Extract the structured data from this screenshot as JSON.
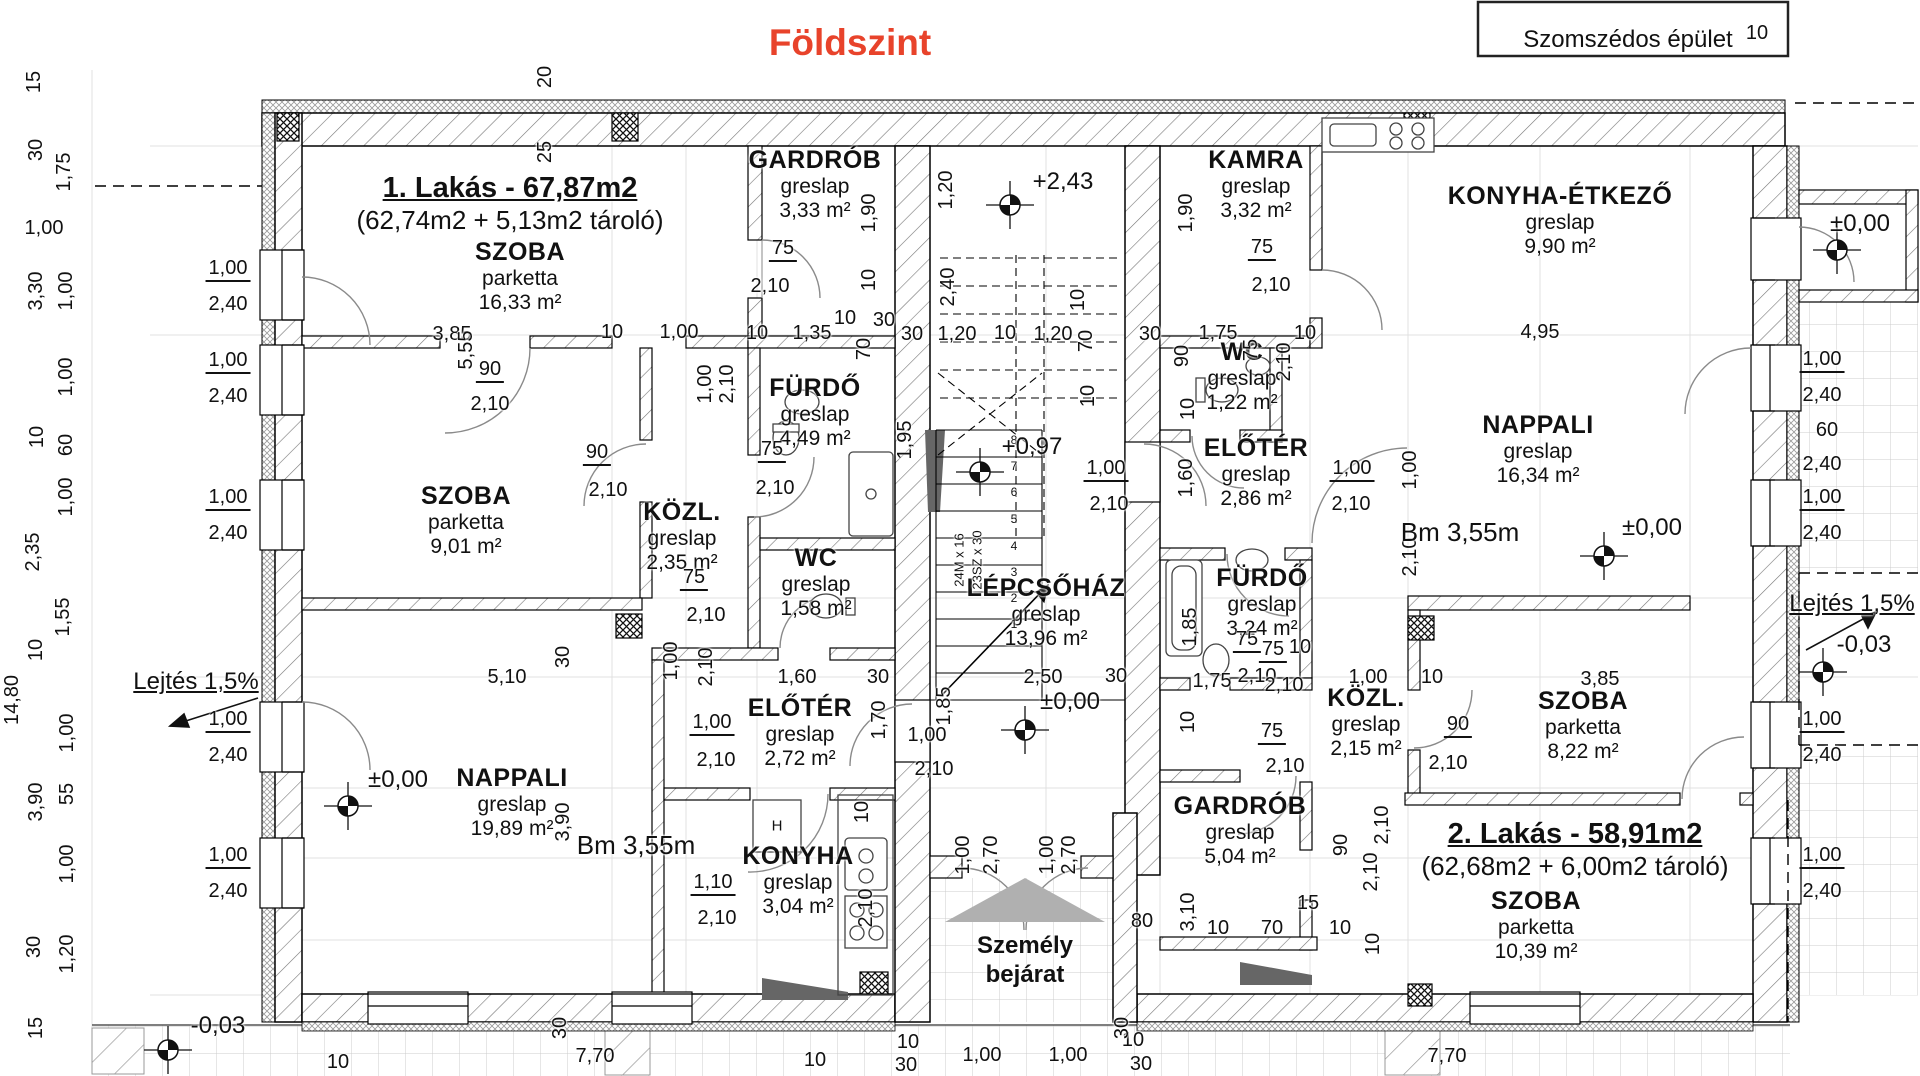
{
  "title": {
    "text": "Földszint",
    "color": "#e8432b"
  },
  "site": {
    "neighbor_label": "Szomszédos épület",
    "entrance_line1": "Személy",
    "entrance_line2": "bejárat",
    "slope_left": "Lejtés 1,5%",
    "slope_right": "Lejtés 1,5%"
  },
  "apartments": [
    {
      "name": "1. Lakás - 67,87m2",
      "detail": "(62,74m2 + 5,13m2 tároló)"
    },
    {
      "name": "2. Lakás - 58,91m2",
      "detail": "(62,68m2 + 6,00m2 tároló)"
    }
  ],
  "stairs": {
    "note1": "24M x 16",
    "note2": "23SZ x 30"
  },
  "kitchen": {
    "cabinet_label": "H"
  },
  "rooms": [
    {
      "name": "SZOBA",
      "floor": "parketta",
      "area": "16,33 m²",
      "cx": 520,
      "cy": 252
    },
    {
      "name": "GARDRÓB",
      "floor": "greslap",
      "area": "3,33 m²",
      "cx": 815,
      "cy": 160
    },
    {
      "name": "FÜRDŐ",
      "floor": "greslap",
      "area": "4,49 m²",
      "cx": 815,
      "cy": 388
    },
    {
      "name": "KÖZL.",
      "floor": "greslap",
      "area": "2,35 m²",
      "cx": 682,
      "cy": 512
    },
    {
      "name": "WC",
      "floor": "greslap",
      "area": "1,58 m²",
      "cx": 816,
      "cy": 558
    },
    {
      "name": "SZOBA",
      "floor": "parketta",
      "area": "9,01 m²",
      "cx": 466,
      "cy": 496
    },
    {
      "name": "LÉPCSŐHÁZ",
      "floor": "greslap",
      "area": "13,96 m²",
      "cx": 1046,
      "cy": 588
    },
    {
      "name": "ELŐTÉR",
      "floor": "greslap",
      "area": "2,72 m²",
      "cx": 800,
      "cy": 708
    },
    {
      "name": "NAPPALI",
      "floor": "greslap",
      "area": "19,89 m²",
      "cx": 512,
      "cy": 778
    },
    {
      "name": "KONYHA",
      "floor": "greslap",
      "area": "3,04 m²",
      "cx": 798,
      "cy": 856
    },
    {
      "name": "KAMRA",
      "floor": "greslap",
      "area": "3,32 m²",
      "cx": 1256,
      "cy": 160
    },
    {
      "name": "KONYHA-ÉTKEZŐ",
      "floor": "greslap",
      "area": "9,90 m²",
      "cx": 1560,
      "cy": 196
    },
    {
      "name": "WC",
      "floor": "greslap",
      "area": "1,22 m²",
      "cx": 1242,
      "cy": 352
    },
    {
      "name": "ELŐTÉR",
      "floor": "greslap",
      "area": "2,86 m²",
      "cx": 1256,
      "cy": 448
    },
    {
      "name": "NAPPALI",
      "floor": "greslap",
      "area": "16,34 m²",
      "cx": 1538,
      "cy": 425
    },
    {
      "name": "FÜRDŐ",
      "floor": "greslap",
      "area": "3,24 m²",
      "cx": 1262,
      "cy": 578
    },
    {
      "name": "KÖZL.",
      "floor": "greslap",
      "area": "2,15 m²",
      "cx": 1366,
      "cy": 698
    },
    {
      "name": "SZOBA",
      "floor": "parketta",
      "area": "8,22 m²",
      "cx": 1583,
      "cy": 701
    },
    {
      "name": "GARDRÓB",
      "floor": "greslap",
      "area": "5,04 m²",
      "cx": 1240,
      "cy": 806
    },
    {
      "name": "SZOBA",
      "floor": "parketta",
      "area": "10,39 m²",
      "cx": 1536,
      "cy": 901
    }
  ],
  "levels": [
    {
      "t": "+2,43",
      "x": 1063,
      "y": 182,
      "mx": 1010,
      "my": 205
    },
    {
      "t": "+0,97",
      "x": 1032,
      "y": 447,
      "mx": 980,
      "my": 472
    },
    {
      "t": "±0,00",
      "x": 1070,
      "y": 702,
      "mx": 1025,
      "my": 730
    },
    {
      "t": "±0,00",
      "x": 398,
      "y": 780,
      "mx": 348,
      "my": 806
    },
    {
      "t": "±0,00",
      "x": 1652,
      "y": 528,
      "mx": 1604,
      "my": 556
    },
    {
      "t": "±0,00",
      "x": 1860,
      "y": 224,
      "mx": 1837,
      "my": 250
    },
    {
      "t": "-0,03",
      "x": 1864,
      "y": 645,
      "mx": 1823,
      "my": 672
    },
    {
      "t": "-0,03",
      "x": 218,
      "y": 1026,
      "mx": 168,
      "my": 1050
    }
  ],
  "labels": [
    {
      "t": "20",
      "x": 545,
      "y": 77,
      "r": 1
    },
    {
      "t": "25",
      "x": 545,
      "y": 152,
      "r": 1
    },
    {
      "t": "15",
      "x": 34,
      "y": 82,
      "r": 1
    },
    {
      "t": "30",
      "x": 36,
      "y": 150,
      "r": 1
    },
    {
      "t": "1,75",
      "x": 64,
      "y": 172,
      "r": 1
    },
    {
      "t": "1,00",
      "x": 44,
      "y": 228
    },
    {
      "t": "3,30",
      "x": 36,
      "y": 291,
      "r": 1
    },
    {
      "t": "1,00",
      "x": 66,
      "y": 291,
      "r": 1
    },
    {
      "t": "1,00",
      "x": 66,
      "y": 377,
      "r": 1
    },
    {
      "t": "10",
      "x": 37,
      "y": 437,
      "r": 1
    },
    {
      "t": "60",
      "x": 66,
      "y": 445,
      "r": 1
    },
    {
      "t": "1,00",
      "x": 66,
      "y": 497,
      "r": 1
    },
    {
      "t": "2,35",
      "x": 33,
      "y": 552,
      "r": 1
    },
    {
      "t": "1,55",
      "x": 63,
      "y": 617,
      "r": 1
    },
    {
      "t": "10",
      "x": 36,
      "y": 650,
      "r": 1
    },
    {
      "t": "14,80",
      "x": 12,
      "y": 700,
      "r": 1
    },
    {
      "t": "1,00",
      "x": 67,
      "y": 733,
      "r": 1
    },
    {
      "t": "55",
      "x": 67,
      "y": 794,
      "r": 1
    },
    {
      "t": "3,90",
      "x": 36,
      "y": 802,
      "r": 1
    },
    {
      "t": "1,00",
      "x": 67,
      "y": 864,
      "r": 1
    },
    {
      "t": "30",
      "x": 34,
      "y": 947,
      "r": 1
    },
    {
      "t": "1,20",
      "x": 67,
      "y": 954,
      "r": 1
    },
    {
      "t": "15",
      "x": 36,
      "y": 1028,
      "r": 1
    },
    {
      "t": "1,00",
      "x": 228,
      "y": 270,
      "u": 1
    },
    {
      "t": "2,40",
      "x": 228,
      "y": 304
    },
    {
      "t": "1,00",
      "x": 228,
      "y": 362,
      "u": 1
    },
    {
      "t": "2,40",
      "x": 228,
      "y": 396
    },
    {
      "t": "1,00",
      "x": 228,
      "y": 499,
      "u": 1
    },
    {
      "t": "2,40",
      "x": 228,
      "y": 533
    },
    {
      "t": "1,00",
      "x": 228,
      "y": 721,
      "u": 1
    },
    {
      "t": "2,40",
      "x": 228,
      "y": 755
    },
    {
      "t": "1,00",
      "x": 228,
      "y": 857,
      "u": 1
    },
    {
      "t": "2,40",
      "x": 228,
      "y": 891
    },
    {
      "t": "1,00",
      "x": 1822,
      "y": 361,
      "u": 1
    },
    {
      "t": "2,40",
      "x": 1822,
      "y": 395
    },
    {
      "t": "60",
      "x": 1827,
      "y": 430
    },
    {
      "t": "2,40",
      "x": 1822,
      "y": 464
    },
    {
      "t": "1,00",
      "x": 1822,
      "y": 499,
      "u": 1
    },
    {
      "t": "2,40",
      "x": 1822,
      "y": 533
    },
    {
      "t": "1,00",
      "x": 1822,
      "y": 721,
      "u": 1
    },
    {
      "t": "2,40",
      "x": 1822,
      "y": 755
    },
    {
      "t": "1,00",
      "x": 1822,
      "y": 857,
      "u": 1
    },
    {
      "t": "2,40",
      "x": 1822,
      "y": 891
    },
    {
      "t": "3,85",
      "x": 452,
      "y": 334
    },
    {
      "t": "10",
      "x": 612,
      "y": 332
    },
    {
      "t": "1,00",
      "x": 679,
      "y": 332
    },
    {
      "t": "10",
      "x": 757,
      "y": 333
    },
    {
      "t": "1,35",
      "x": 812,
      "y": 333
    },
    {
      "t": "10",
      "x": 845,
      "y": 318
    },
    {
      "t": "30",
      "x": 884,
      "y": 320
    },
    {
      "t": "70",
      "x": 864,
      "y": 349,
      "r": 1
    },
    {
      "t": "30",
      "x": 912,
      "y": 334
    },
    {
      "t": "1,20",
      "x": 957,
      "y": 334
    },
    {
      "t": "10",
      "x": 1005,
      "y": 333
    },
    {
      "t": "1,20",
      "x": 1053,
      "y": 334
    },
    {
      "t": "30",
      "x": 1150,
      "y": 334
    },
    {
      "t": "1,75",
      "x": 1218,
      "y": 333
    },
    {
      "t": "10",
      "x": 1305,
      "y": 333
    },
    {
      "t": "4,95",
      "x": 1540,
      "y": 332
    },
    {
      "t": "90",
      "x": 1182,
      "y": 356,
      "r": 1
    },
    {
      "t": "75",
      "x": 1251,
      "y": 350,
      "r": 1
    },
    {
      "t": "2,10",
      "x": 1284,
      "y": 362,
      "r": 1
    },
    {
      "t": "1,20",
      "x": 946,
      "y": 190,
      "r": 1
    },
    {
      "t": "2,40",
      "x": 948,
      "y": 287,
      "r": 1
    },
    {
      "t": "10",
      "x": 1078,
      "y": 300,
      "r": 1
    },
    {
      "t": "70",
      "x": 1086,
      "y": 341,
      "r": 1
    },
    {
      "t": "10",
      "x": 1088,
      "y": 396,
      "r": 1
    },
    {
      "t": "1,90",
      "x": 869,
      "y": 213,
      "r": 1
    },
    {
      "t": "10",
      "x": 869,
      "y": 280,
      "r": 1
    },
    {
      "t": "1,90",
      "x": 1186,
      "y": 213,
      "r": 1
    },
    {
      "t": "75",
      "x": 783,
      "y": 250,
      "u": 1
    },
    {
      "t": "2,10",
      "x": 770,
      "y": 286
    },
    {
      "t": "75",
      "x": 1262,
      "y": 249,
      "u": 1
    },
    {
      "t": "2,10",
      "x": 1271,
      "y": 285
    },
    {
      "t": "90",
      "x": 490,
      "y": 371,
      "u": 1
    },
    {
      "t": "2,10",
      "x": 490,
      "y": 404
    },
    {
      "t": "5,55",
      "x": 466,
      "y": 350,
      "r": 1
    },
    {
      "t": "75",
      "x": 772,
      "y": 451,
      "u": 1
    },
    {
      "t": "2,10",
      "x": 775,
      "y": 488
    },
    {
      "t": "90",
      "x": 597,
      "y": 454,
      "u": 1
    },
    {
      "t": "2,10",
      "x": 608,
      "y": 490
    },
    {
      "t": "1,00",
      "x": 705,
      "y": 384,
      "r": 1
    },
    {
      "t": "2,10",
      "x": 727,
      "y": 384,
      "r": 1
    },
    {
      "t": "1,95",
      "x": 905,
      "y": 440,
      "r": 1
    },
    {
      "t": "75",
      "x": 694,
      "y": 579,
      "u": 1
    },
    {
      "t": "2,10",
      "x": 706,
      "y": 615
    },
    {
      "t": "1,00",
      "x": 671,
      "y": 661,
      "r": 1
    },
    {
      "t": "2,10",
      "x": 706,
      "y": 667,
      "r": 1
    },
    {
      "t": "5,10",
      "x": 507,
      "y": 677
    },
    {
      "t": "30",
      "x": 563,
      "y": 657,
      "r": 1
    },
    {
      "t": "1,60",
      "x": 797,
      "y": 677
    },
    {
      "t": "30",
      "x": 878,
      "y": 677
    },
    {
      "t": "2,50",
      "x": 1043,
      "y": 677
    },
    {
      "t": "30",
      "x": 1116,
      "y": 676
    },
    {
      "t": "1,85",
      "x": 944,
      "y": 706,
      "r": 1
    },
    {
      "t": "1,70",
      "x": 879,
      "y": 720,
      "r": 1
    },
    {
      "t": "1,00",
      "x": 927,
      "y": 735
    },
    {
      "t": "2,10",
      "x": 934,
      "y": 769
    },
    {
      "t": "1,00",
      "x": 712,
      "y": 724,
      "u": 1
    },
    {
      "t": "2,10",
      "x": 716,
      "y": 760
    },
    {
      "t": "3,90",
      "x": 563,
      "y": 822,
      "r": 1
    },
    {
      "t": "1,10",
      "x": 713,
      "y": 884,
      "u": 1
    },
    {
      "t": "2,10",
      "x": 717,
      "y": 918
    },
    {
      "t": "10",
      "x": 862,
      "y": 812,
      "r": 1
    },
    {
      "t": "2,10",
      "x": 866,
      "y": 908,
      "r": 1
    },
    {
      "t": "7,70",
      "x": 595,
      "y": 1056
    },
    {
      "t": "30",
      "x": 560,
      "y": 1028,
      "r": 1
    },
    {
      "t": "10",
      "x": 338,
      "y": 1062
    },
    {
      "t": "10",
      "x": 815,
      "y": 1060
    },
    {
      "t": "10",
      "x": 908,
      "y": 1042
    },
    {
      "t": "30",
      "x": 906,
      "y": 1065
    },
    {
      "t": "1,00",
      "x": 982,
      "y": 1055
    },
    {
      "t": "1,00",
      "x": 1068,
      "y": 1055
    },
    {
      "t": "10",
      "x": 1133,
      "y": 1040
    },
    {
      "t": "30",
      "x": 1141,
      "y": 1064
    },
    {
      "t": "30",
      "x": 1122,
      "y": 1028,
      "r": 1
    },
    {
      "t": "7,70",
      "x": 1447,
      "y": 1056
    },
    {
      "t": "1,00",
      "x": 963,
      "y": 855,
      "r": 1
    },
    {
      "t": "2,70",
      "x": 991,
      "y": 855,
      "r": 1
    },
    {
      "t": "1,00",
      "x": 1047,
      "y": 855,
      "r": 1
    },
    {
      "t": "2,70",
      "x": 1069,
      "y": 855,
      "r": 1
    },
    {
      "t": "80",
      "x": 1142,
      "y": 921
    },
    {
      "t": "1,60",
      "x": 1186,
      "y": 478,
      "r": 1
    },
    {
      "t": "1,00",
      "x": 1106,
      "y": 470,
      "u": 1
    },
    {
      "t": "2,10",
      "x": 1109,
      "y": 504
    },
    {
      "t": "1,00",
      "x": 1352,
      "y": 470,
      "u": 1
    },
    {
      "t": "2,10",
      "x": 1351,
      "y": 504
    },
    {
      "t": "1,00",
      "x": 1410,
      "y": 470,
      "r": 1
    },
    {
      "t": "2,10",
      "x": 1410,
      "y": 557,
      "r": 1
    },
    {
      "t": "10",
      "x": 1188,
      "y": 409,
      "r": 1
    },
    {
      "t": "1,85",
      "x": 1190,
      "y": 627,
      "r": 1
    },
    {
      "t": "75",
      "x": 1247,
      "y": 641,
      "u": 1
    },
    {
      "t": "2,10",
      "x": 1257,
      "y": 676
    },
    {
      "t": "1,75",
      "x": 1212,
      "y": 681
    },
    {
      "t": "10",
      "x": 1300,
      "y": 647
    },
    {
      "t": "1,00",
      "x": 1368,
      "y": 677
    },
    {
      "t": "10",
      "x": 1432,
      "y": 677
    },
    {
      "t": "3,85",
      "x": 1600,
      "y": 679
    },
    {
      "t": "75",
      "x": 1273,
      "y": 651,
      "u": 1
    },
    {
      "t": "2,10",
      "x": 1284,
      "y": 685
    },
    {
      "t": "75",
      "x": 1272,
      "y": 733,
      "u": 1
    },
    {
      "t": "2,10",
      "x": 1285,
      "y": 766
    },
    {
      "t": "90",
      "x": 1458,
      "y": 726,
      "u": 1
    },
    {
      "t": "2,10",
      "x": 1448,
      "y": 763
    },
    {
      "t": "10",
      "x": 1188,
      "y": 722,
      "r": 1
    },
    {
      "t": "90",
      "x": 1341,
      "y": 845,
      "r": 1
    },
    {
      "t": "2,10",
      "x": 1371,
      "y": 872,
      "r": 1
    },
    {
      "t": "2,10",
      "x": 1382,
      "y": 825,
      "r": 1
    },
    {
      "t": "3,10",
      "x": 1188,
      "y": 912,
      "r": 1
    },
    {
      "t": "10",
      "x": 1218,
      "y": 928
    },
    {
      "t": "70",
      "x": 1272,
      "y": 928
    },
    {
      "t": "15",
      "x": 1308,
      "y": 903
    },
    {
      "t": "10",
      "x": 1340,
      "y": 928
    },
    {
      "t": "10",
      "x": 1373,
      "y": 944,
      "r": 1
    },
    {
      "t": "10",
      "x": 1757,
      "y": 33
    },
    {
      "t": "Bm 3,55m",
      "x": 636,
      "y": 845,
      "s": 26
    },
    {
      "t": "Bm 3,55m",
      "x": 1460,
      "y": 532,
      "s": 26
    },
    {
      "t": "24M x 16",
      "x": 959,
      "y": 560,
      "r": 1,
      "s": 13
    },
    {
      "t": "23SZ x 30",
      "x": 977,
      "y": 560,
      "r": 1,
      "s": 13
    },
    {
      "t": "8",
      "x": 1014,
      "y": 440,
      "s": 12
    },
    {
      "t": "7",
      "x": 1014,
      "y": 466,
      "s": 12
    },
    {
      "t": "6",
      "x": 1014,
      "y": 492,
      "s": 12
    },
    {
      "t": "5",
      "x": 1014,
      "y": 519,
      "s": 12
    },
    {
      "t": "4",
      "x": 1014,
      "y": 546,
      "s": 12
    },
    {
      "t": "3",
      "x": 1014,
      "y": 572,
      "s": 12
    },
    {
      "t": "2",
      "x": 1014,
      "y": 598,
      "s": 12
    },
    {
      "t": "1",
      "x": 1014,
      "y": 624,
      "s": 12
    },
    {
      "t": "H",
      "x": 777,
      "y": 826,
      "s": 15
    }
  ]
}
